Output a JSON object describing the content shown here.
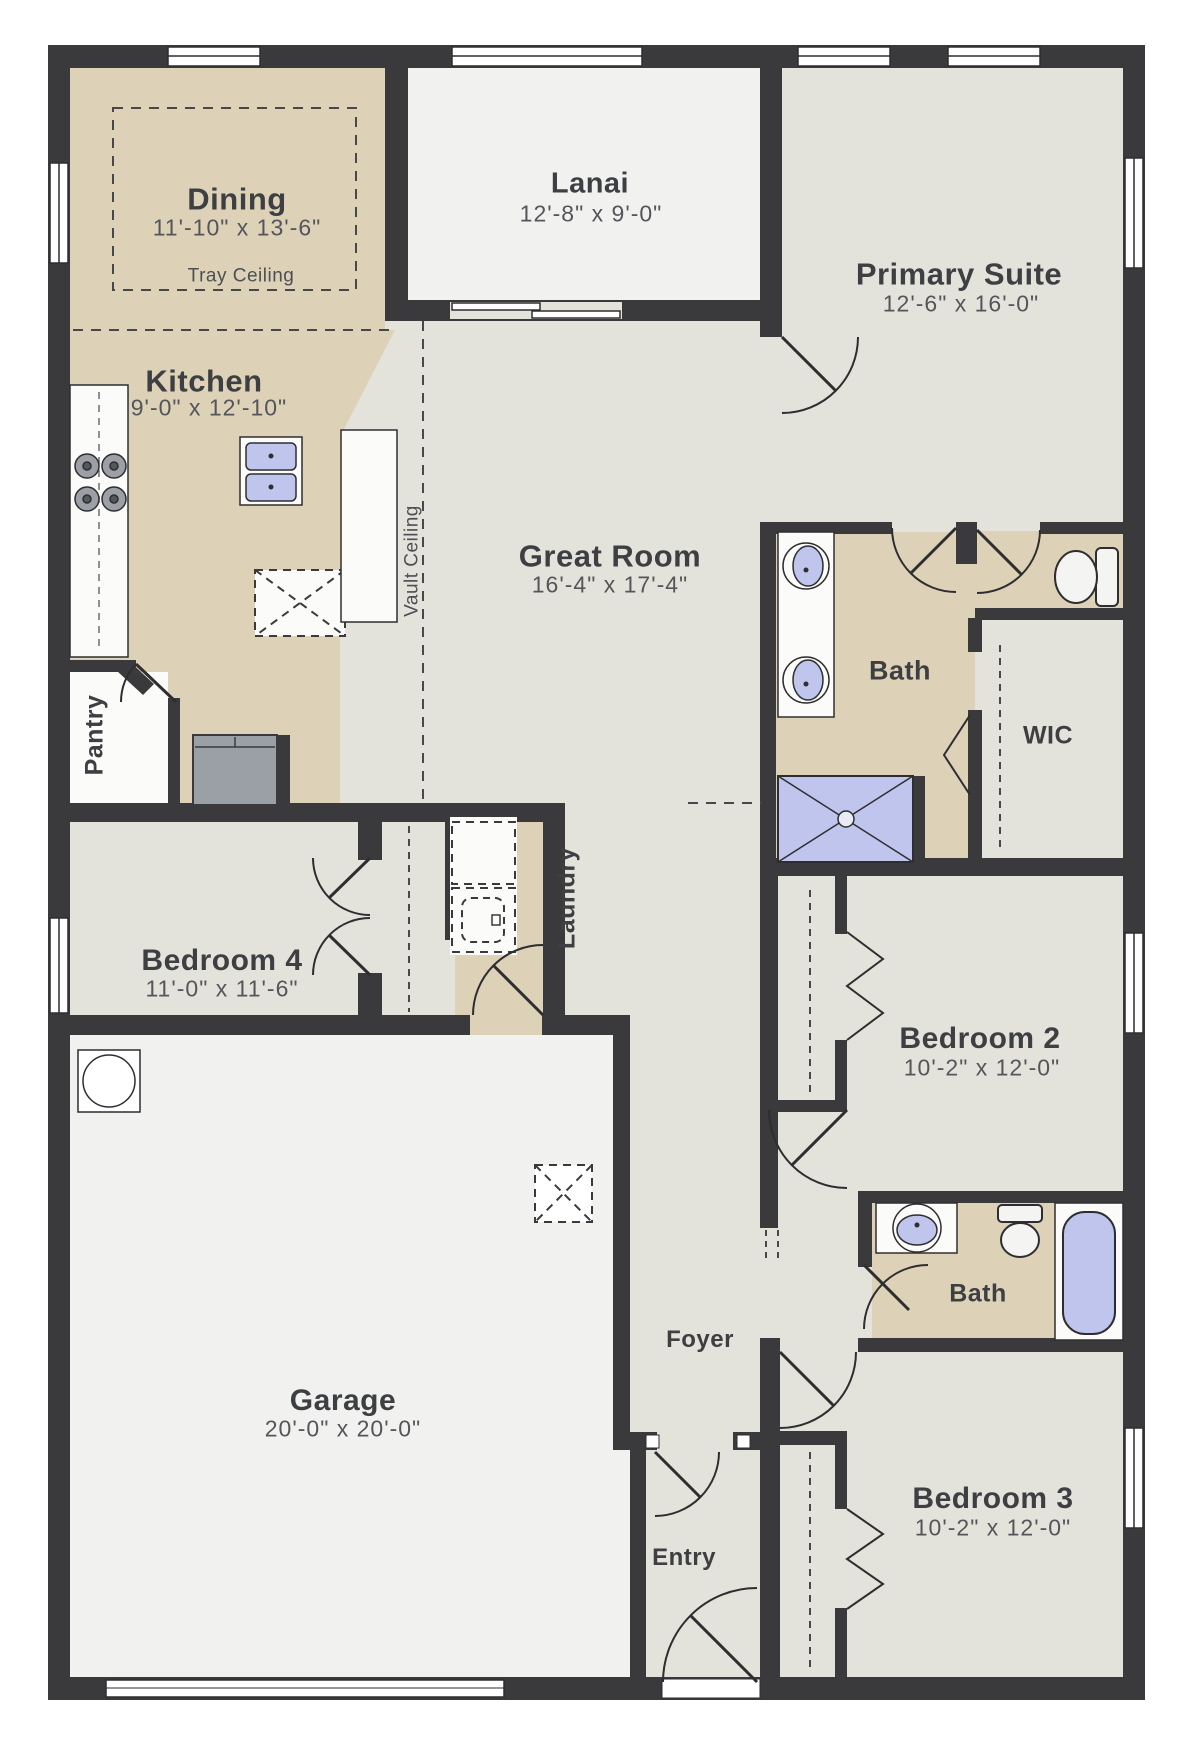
{
  "rooms": {
    "dining": {
      "name": "Dining",
      "dims": "11'-10\" x 13'-6\"",
      "note": "Tray Ceiling"
    },
    "lanai": {
      "name": "Lanai",
      "dims": "12'-8\" x 9'-0\""
    },
    "primary_suite": {
      "name": "Primary Suite",
      "dims": "12'-6\" x 16'-0\""
    },
    "kitchen": {
      "name": "Kitchen",
      "dims": "9'-0\" x 12'-10\""
    },
    "great_room": {
      "name": "Great Room",
      "dims": "16'-4\" x 17'-4\"",
      "note": "Vault Ceiling"
    },
    "primary_bath": {
      "name": "Bath"
    },
    "wic": {
      "name": "WIC"
    },
    "pantry": {
      "name": "Pantry"
    },
    "bedroom4": {
      "name": "Bedroom 4",
      "dims": "11'-0\" x 11'-6\""
    },
    "laundry": {
      "name": "Laundry"
    },
    "bedroom2": {
      "name": "Bedroom 2",
      "dims": "10'-2\" x 12'-0\""
    },
    "bath2": {
      "name": "Bath"
    },
    "bedroom3": {
      "name": "Bedroom 3",
      "dims": "10'-2\" x 12'-0\""
    },
    "garage": {
      "name": "Garage",
      "dims": "20'-0\" x 20'-0\""
    },
    "foyer": {
      "name": "Foyer"
    },
    "entry": {
      "name": "Entry"
    }
  },
  "colors": {
    "wall": "#3a3a3c",
    "floor_light": "#e4e3db",
    "floor_tan": "#ddd2b8",
    "floor_white": "#f1f1f0",
    "fixture_white": "#fbfbfa",
    "fixture_blue": "#bfc5ec",
    "appliance_gray": "#9aa0a6",
    "line": "#2e2e30",
    "text": "#3d3f42"
  }
}
